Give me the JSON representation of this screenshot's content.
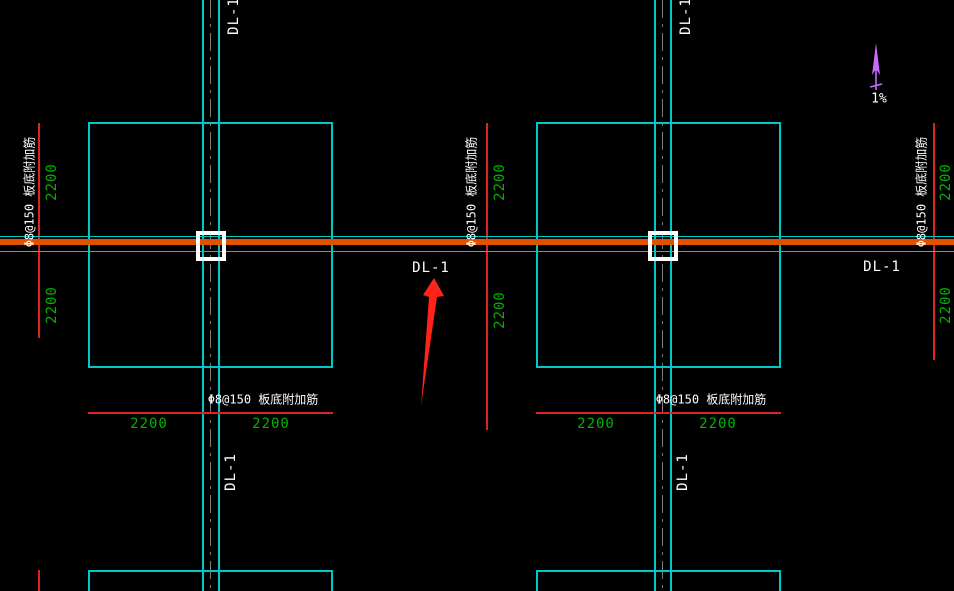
{
  "drawing": {
    "beam_label": "DL-1",
    "rebar_note": "Φ8@150 板底附加筋",
    "dim_value": "2200",
    "slope_label": "1%"
  },
  "colors": {
    "background": "#000000",
    "slab_outline_cyan": "#00c8c8",
    "beam_orange": "#e05200",
    "grid_red": "#dd2222",
    "dimension_green": "#00b400",
    "annotation_white": "#ffffff",
    "centerline_gray": "#7d7d7d",
    "slope_arrow_magenta": "#c96aff",
    "pointer_arrow_red": "#ff2417"
  }
}
